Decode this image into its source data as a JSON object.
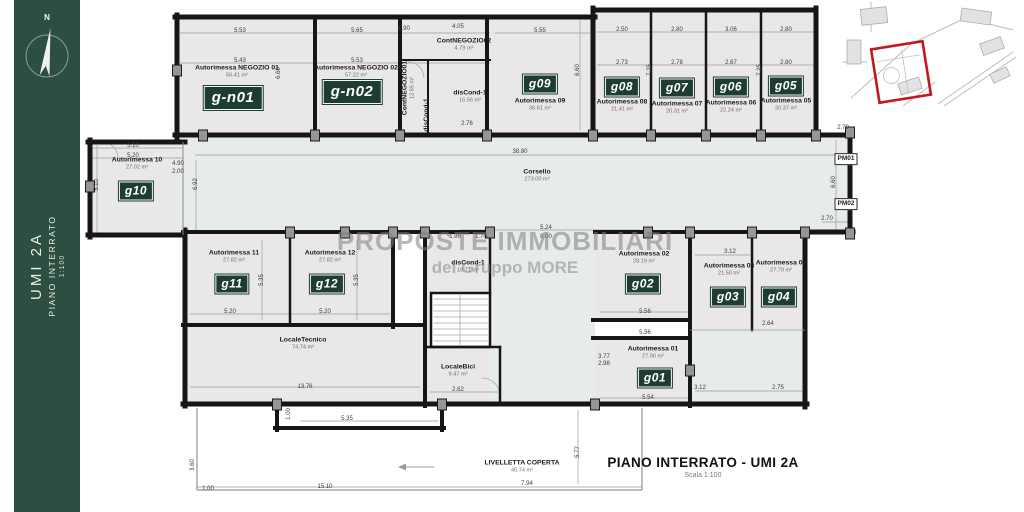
{
  "colors": {
    "sidebar": "#2d4f41",
    "badge": "#1d3d30",
    "wall": "#161616",
    "room": "#eae8e6",
    "corridor": "#e8ece9",
    "highlight_red": "#c1181d"
  },
  "sidebar": {
    "compass_label": "N",
    "title": "UMI 2A",
    "subtitle": "PIANO INTERRATO",
    "scale": "1:100"
  },
  "watermark": {
    "line1": "PROPOSTE IMMOBILIARI",
    "line2": "del Gruppo MORE"
  },
  "title_block": {
    "title": "PIANO INTERRATO - UMI 2A",
    "scale": "Scala 1:100"
  },
  "plan": {
    "rooms": [
      {
        "badge": "g-n01",
        "large": true,
        "name": "Autorimessa NEGOZIO 01",
        "area": "56.41 m²",
        "label_x": 237,
        "label_y": 72,
        "badge_x": 233,
        "badge_y": 98
      },
      {
        "badge": "g-n02",
        "large": true,
        "name": "Autorimessa NEGOZIO 02",
        "area": "57.22 m²",
        "label_x": 356,
        "label_y": 72,
        "badge_x": 352,
        "badge_y": 92
      },
      {
        "badge": "g09",
        "name": "Autorimessa 09",
        "area": "36.61 m²",
        "label_x": 540,
        "label_y": 105,
        "badge_x": 540,
        "badge_y": 84
      },
      {
        "badge": "g08",
        "name": "Autorimessa 08",
        "area": "21.41 m²",
        "label_x": 622,
        "label_y": 106,
        "badge_x": 622,
        "badge_y": 87
      },
      {
        "badge": "g07",
        "name": "Autorimessa 07",
        "area": "20.31 m²",
        "label_x": 677,
        "label_y": 108,
        "badge_x": 677,
        "badge_y": 88
      },
      {
        "badge": "g06",
        "name": "Autorimessa 06",
        "area": "22.24 m²",
        "label_x": 731,
        "label_y": 107,
        "badge_x": 731,
        "badge_y": 87
      },
      {
        "badge": "g05",
        "name": "Autorimessa 05",
        "area": "20.37 m²",
        "label_x": 786,
        "label_y": 105,
        "badge_x": 786,
        "badge_y": 86
      },
      {
        "badge": "g10",
        "name": "Autorimessa 10",
        "area": "27.02 m²",
        "label_x": 137,
        "label_y": 164,
        "badge_x": 136,
        "badge_y": 191
      },
      {
        "badge": "g11",
        "name": "Autorimessa 11",
        "area": "27.82 m²",
        "label_x": 234,
        "label_y": 257,
        "badge_x": 232,
        "badge_y": 284
      },
      {
        "badge": "g12",
        "name": "Autorimessa 12",
        "area": "27.82 m²",
        "label_x": 330,
        "label_y": 257,
        "badge_x": 327,
        "badge_y": 284
      },
      {
        "badge": "g02",
        "name": "Autorimessa 02",
        "area": "28.19 m²",
        "label_x": 644,
        "label_y": 258,
        "badge_x": 643,
        "badge_y": 284
      },
      {
        "badge": "g03",
        "name": "Autorimessa 03",
        "area": "21.50 m²",
        "label_x": 729,
        "label_y": 270,
        "badge_x": 728,
        "badge_y": 297
      },
      {
        "badge": "g04",
        "name": "Autorimessa 04",
        "area": "27.79 m²",
        "label_x": 781,
        "label_y": 267,
        "badge_x": 779,
        "badge_y": 297
      },
      {
        "badge": "g01",
        "name": "Autorimessa 01",
        "area": "27.90 m²",
        "label_x": 653,
        "label_y": 353,
        "badge_x": 655,
        "badge_y": 378
      }
    ],
    "labels": [
      {
        "text": "Corsello",
        "area": "273.00 m²",
        "x": 537,
        "y": 176
      },
      {
        "text": "ContNEGOZIO02",
        "area": "4.79 m²",
        "x": 464,
        "y": 45
      },
      {
        "text": "ContNEGOZIO01",
        "area": "12.65 m²",
        "x": 409,
        "y": 88,
        "vertical": true
      },
      {
        "text": "disCond-1",
        "area": "16.56 m²",
        "x": 470,
        "y": 97
      },
      {
        "text": "disCond-1",
        "x": 427,
        "y": 115,
        "vertical": true
      },
      {
        "text": "disCond-1",
        "area": "18.71 m²",
        "x": 468,
        "y": 267
      },
      {
        "text": "LocaleTecnico",
        "area": "74.74 m²",
        "x": 303,
        "y": 344
      },
      {
        "text": "LocaleBici",
        "area": "9.47 m²",
        "x": 458,
        "y": 371
      },
      {
        "text": "LIVELLETTA COPERTA",
        "area": "45.74 m²",
        "x": 522,
        "y": 467
      },
      {
        "text": "PM01",
        "x": 846,
        "y": 159,
        "boxed": true
      },
      {
        "text": "PM02",
        "x": 846,
        "y": 204,
        "boxed": true
      }
    ],
    "dimensions": [
      {
        "t": "5.53",
        "x": 240,
        "y": 31
      },
      {
        "t": "5.43",
        "x": 240,
        "y": 61
      },
      {
        "t": "5.65",
        "x": 357,
        "y": 31
      },
      {
        "t": "5.53",
        "x": 357,
        "y": 61
      },
      {
        "t": "1.90",
        "x": 404,
        "y": 29
      },
      {
        "t": "4.05",
        "x": 458,
        "y": 27
      },
      {
        "t": "5.55",
        "x": 540,
        "y": 31
      },
      {
        "t": "2.50",
        "x": 622,
        "y": 30
      },
      {
        "t": "2.80",
        "x": 677,
        "y": 30
      },
      {
        "t": "3.06",
        "x": 731,
        "y": 30
      },
      {
        "t": "2.80",
        "x": 786,
        "y": 30
      },
      {
        "t": "2.73",
        "x": 622,
        "y": 63
      },
      {
        "t": "2.78",
        "x": 677,
        "y": 63
      },
      {
        "t": "2.67",
        "x": 731,
        "y": 63
      },
      {
        "t": "2.80",
        "x": 786,
        "y": 63
      },
      {
        "t": "7.25",
        "x": 650,
        "y": 70,
        "v": true
      },
      {
        "t": "7.25",
        "x": 760,
        "y": 70,
        "v": true
      },
      {
        "t": "6.60",
        "x": 578,
        "y": 70,
        "v": true
      },
      {
        "t": "6.60",
        "x": 279,
        "y": 73,
        "v": true
      },
      {
        "t": "2.76",
        "x": 467,
        "y": 124
      },
      {
        "t": "38.80",
        "x": 520,
        "y": 152
      },
      {
        "t": "6.92",
        "x": 196,
        "y": 184,
        "v": true
      },
      {
        "t": "5.10",
        "x": 133,
        "y": 146
      },
      {
        "t": "5.20",
        "x": 133,
        "y": 156
      },
      {
        "t": "5.10",
        "x": 97,
        "y": 185,
        "v": true
      },
      {
        "t": "4.90",
        "x": 178,
        "y": 164
      },
      {
        "t": "2.00",
        "x": 178,
        "y": 172
      },
      {
        "t": "2.70",
        "x": 843,
        "y": 128
      },
      {
        "t": "6.60",
        "x": 834,
        "y": 182,
        "v": true
      },
      {
        "t": "2.70",
        "x": 827,
        "y": 219
      },
      {
        "t": "5.35",
        "x": 262,
        "y": 280,
        "v": true
      },
      {
        "t": "5.35",
        "x": 357,
        "y": 280,
        "v": true
      },
      {
        "t": "5.20",
        "x": 230,
        "y": 312
      },
      {
        "t": "5.20",
        "x": 325,
        "y": 312
      },
      {
        "t": "5.24",
        "x": 546,
        "y": 228
      },
      {
        "t": "8.00",
        "x": 546,
        "y": 237
      },
      {
        "t": "1.96",
        "x": 455,
        "y": 237
      },
      {
        "t": "1.70",
        "x": 481,
        "y": 237
      },
      {
        "t": "5.56",
        "x": 645,
        "y": 312
      },
      {
        "t": "5.56",
        "x": 645,
        "y": 333
      },
      {
        "t": "3.12",
        "x": 730,
        "y": 252
      },
      {
        "t": "2.64",
        "x": 768,
        "y": 324
      },
      {
        "t": "3.77",
        "x": 604,
        "y": 357
      },
      {
        "t": "2.98",
        "x": 604,
        "y": 364
      },
      {
        "t": "3.12",
        "x": 700,
        "y": 388
      },
      {
        "t": "2.75",
        "x": 778,
        "y": 388
      },
      {
        "t": "5.54",
        "x": 648,
        "y": 398
      },
      {
        "t": "13.76",
        "x": 305,
        "y": 387
      },
      {
        "t": "1.00",
        "x": 289,
        "y": 414,
        "v": true
      },
      {
        "t": "5.35",
        "x": 347,
        "y": 419
      },
      {
        "t": "2.62",
        "x": 458,
        "y": 390
      },
      {
        "t": "3.60",
        "x": 193,
        "y": 465,
        "v": true
      },
      {
        "t": "1.00",
        "x": 208,
        "y": 489
      },
      {
        "t": "15.10",
        "x": 325,
        "y": 487
      },
      {
        "t": "7.94",
        "x": 527,
        "y": 484
      },
      {
        "t": "5.77",
        "x": 578,
        "y": 452,
        "v": true
      }
    ]
  }
}
